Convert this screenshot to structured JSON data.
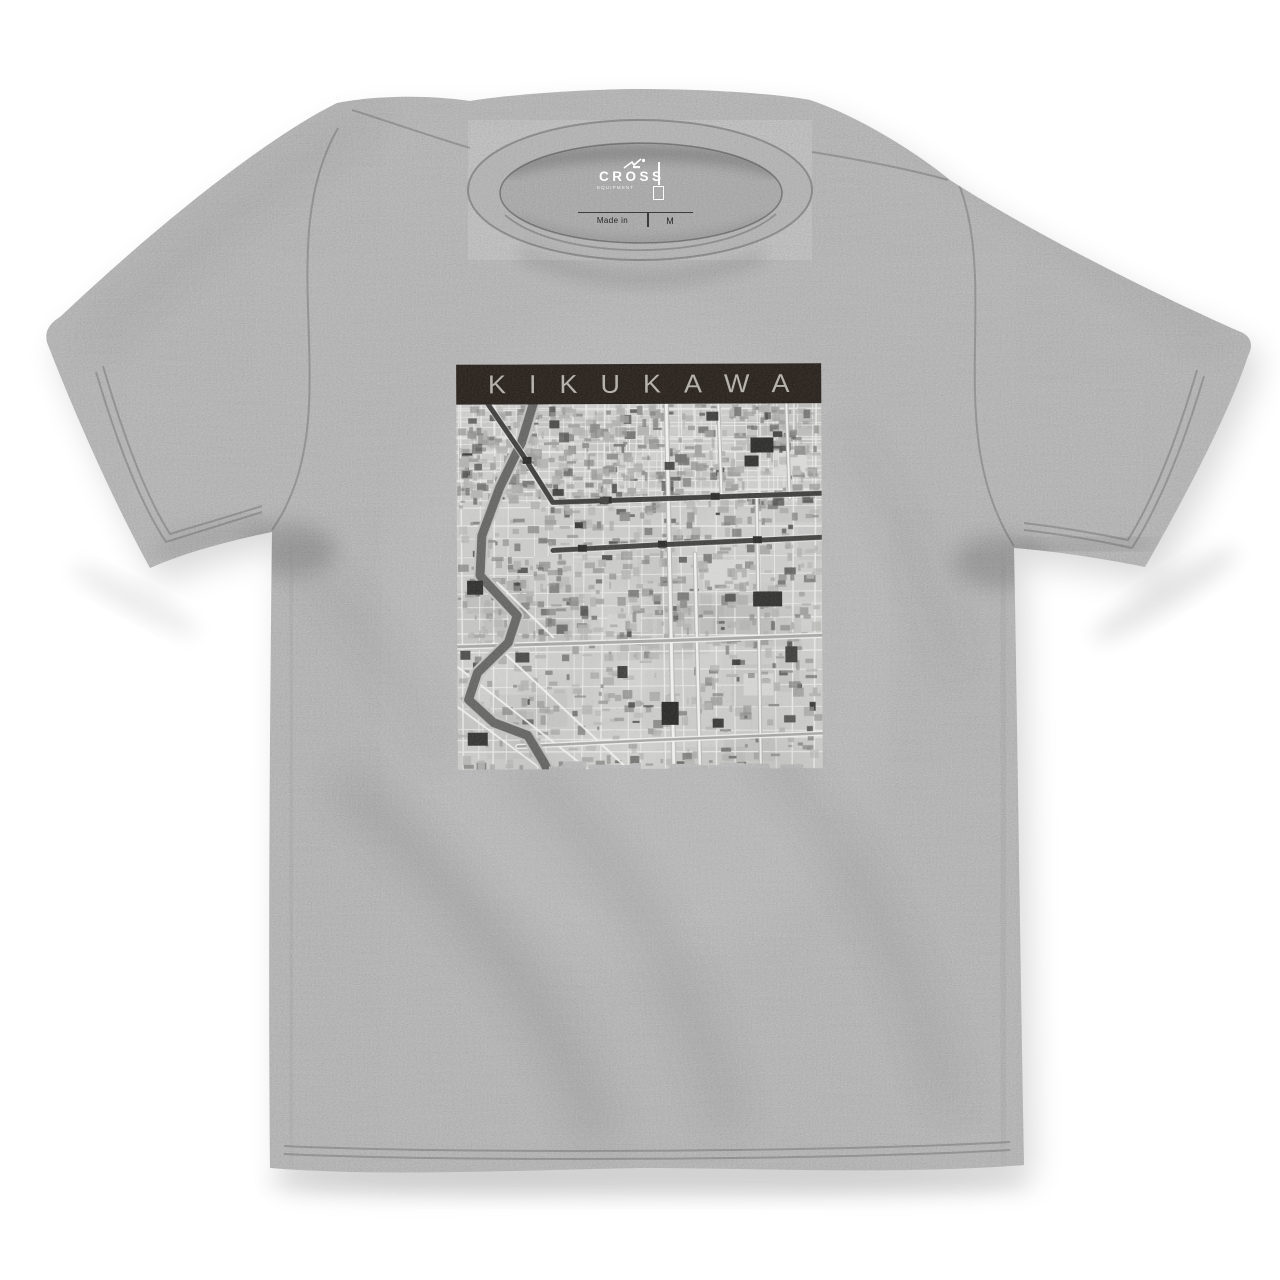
{
  "canvas": {
    "width": 1280,
    "height": 1280,
    "background": "#ffffff"
  },
  "shirt": {
    "fabric_color": "#a8a8a8",
    "fabric_inside_color": "#a1a1a1",
    "collar_band_color": "#aaaaaa",
    "seam_color": "#4a4a4a",
    "drop_shadow_color": "#000000",
    "neck_label": {
      "brand": "CROSS",
      "brand_sub": "EQUIPMENT",
      "made_in": "Made in",
      "size": "M",
      "print_color": "#ffffff",
      "label_ink_color": "#2e2e2e"
    }
  },
  "print": {
    "title": "KIKUKAWA",
    "bar_color": "#261f1a",
    "title_color": "#b3afa9",
    "map": {
      "seed": 11,
      "palette": {
        "base": "#cbcbc9",
        "street": "#eaeae8",
        "street_major": "#f3f3f1",
        "street_casing": "#b4b4b2",
        "road_dark": "#3d3d3b",
        "rail": "#383836",
        "river": "#5c5c5a",
        "river_bank": "#c3c3c1",
        "mid_road": "#a5a5a3"
      },
      "building_shades": [
        "#b1b1af",
        "#9c9c9a",
        "#878785",
        "#6f6f6d",
        "#4d4d4b",
        "#303030"
      ],
      "building_count": 1150,
      "grid": {
        "vMin": 12,
        "vMax": 26,
        "hMin": 11,
        "hMax": 22,
        "slant": 6,
        "upperY": 98,
        "uvMin": 8,
        "uvMax": 15,
        "uhMin": 7,
        "uhMax": 13
      },
      "rail_road": {
        "pts": [
          [
            28,
            -6
          ],
          [
            66,
            50
          ],
          [
            96,
            98
          ],
          [
            200,
            95
          ],
          [
            365,
            90
          ]
        ],
        "w": 5
      },
      "second_road": {
        "pts": [
          [
            96,
            146
          ],
          [
            200,
            141
          ],
          [
            365,
            134
          ]
        ],
        "w": 5
      },
      "mid_road": {
        "pts": [
          [
            0,
            242
          ],
          [
            200,
            237
          ],
          [
            365,
            232
          ]
        ],
        "w": 3
      },
      "bottom_road": {
        "pts": [
          [
            60,
            342
          ],
          [
            200,
            336
          ],
          [
            365,
            330
          ]
        ],
        "w": 2.5
      },
      "major_streets": [
        {
          "x1": 210,
          "y1": 0,
          "x2": 216,
          "y2": 365,
          "w": 3
        },
        {
          "x1": 238,
          "y1": 150,
          "x2": 242,
          "y2": 365,
          "w": 2.5
        },
        {
          "x1": 300,
          "y1": 90,
          "x2": 303,
          "y2": 365,
          "w": 2
        },
        {
          "x1": 262,
          "y1": 0,
          "x2": 265,
          "y2": 95,
          "w": 2
        },
        {
          "x1": 330,
          "y1": 0,
          "x2": 333,
          "y2": 95,
          "w": 2
        }
      ],
      "diag_streets": [
        [
          [
            0,
            262
          ],
          [
            130,
            365
          ]
        ],
        [
          [
            0,
            302
          ],
          [
            84,
            365
          ]
        ],
        [
          [
            36,
            238
          ],
          [
            170,
            365
          ]
        ],
        [
          [
            96,
            233
          ],
          [
            40,
            178
          ]
        ]
      ],
      "river": [
        [
          78,
          -4
        ],
        [
          65,
          38
        ],
        [
          43,
          83
        ],
        [
          25,
          131
        ],
        [
          23,
          171
        ],
        [
          60,
          211
        ],
        [
          51,
          238
        ],
        [
          20,
          268
        ],
        [
          11,
          295
        ],
        [
          36,
          318
        ],
        [
          70,
          331
        ],
        [
          86,
          358
        ],
        [
          92,
          370
        ]
      ],
      "stations": [
        {
          "x": 70,
          "road": 0
        },
        {
          "x": 150,
          "road": 0
        },
        {
          "x": 258,
          "road": 0
        },
        {
          "x": 125,
          "road": 1
        },
        {
          "x": 205,
          "road": 1
        },
        {
          "x": 300,
          "road": 1
        }
      ],
      "landmarks": [
        {
          "x": 294,
          "y": 34,
          "w": 23,
          "h": 15,
          "c": "#262624"
        },
        {
          "x": 250,
          "y": 8,
          "w": 12,
          "h": 9,
          "c": "#3a3a38"
        },
        {
          "x": 208,
          "y": 58,
          "w": 10,
          "h": 8,
          "c": "#444442"
        },
        {
          "x": 288,
          "y": 52,
          "w": 14,
          "h": 11,
          "c": "#2c2c2a"
        },
        {
          "x": 296,
          "y": 188,
          "w": 29,
          "h": 15,
          "c": "#2b2b29"
        },
        {
          "x": 204,
          "y": 298,
          "w": 17,
          "h": 23,
          "c": "#232321"
        },
        {
          "x": 255,
          "y": 315,
          "w": 11,
          "h": 9,
          "c": "#333331"
        },
        {
          "x": 10,
          "y": 176,
          "w": 16,
          "h": 14,
          "c": "#2a2a28"
        },
        {
          "x": 10,
          "y": 328,
          "w": 20,
          "h": 13,
          "c": "#2e2e2c"
        },
        {
          "x": 143,
          "y": 93,
          "w": 9,
          "h": 7,
          "c": "#3c3c3a"
        },
        {
          "x": 93,
          "y": 16,
          "w": 10,
          "h": 8,
          "c": "#454543"
        },
        {
          "x": 328,
          "y": 243,
          "w": 12,
          "h": 16,
          "c": "#3a3a38"
        },
        {
          "x": 58,
          "y": 248,
          "w": 14,
          "h": 10,
          "c": "#454543"
        },
        {
          "x": 160,
          "y": 262,
          "w": 10,
          "h": 12,
          "c": "#3a3a38"
        },
        {
          "x": 118,
          "y": 118,
          "w": 8,
          "h": 6,
          "c": "#333331"
        },
        {
          "x": 3,
          "y": 246,
          "w": 10,
          "h": 9,
          "c": "#4a4a48"
        }
      ],
      "light_parcels": [
        {
          "x": 246,
          "y": 156,
          "w": 46,
          "h": 30,
          "c": "#d7d7d5"
        },
        {
          "x": 318,
          "y": 48,
          "w": 32,
          "h": 24,
          "c": "#dadad8"
        },
        {
          "x": 76,
          "y": 152,
          "w": 40,
          "h": 20,
          "c": "#d0d0ce"
        },
        {
          "x": 150,
          "y": 210,
          "w": 34,
          "h": 18,
          "c": "#d3d3d1"
        },
        {
          "x": 286,
          "y": 270,
          "w": 30,
          "h": 22,
          "c": "#d5d5d3"
        }
      ]
    }
  }
}
